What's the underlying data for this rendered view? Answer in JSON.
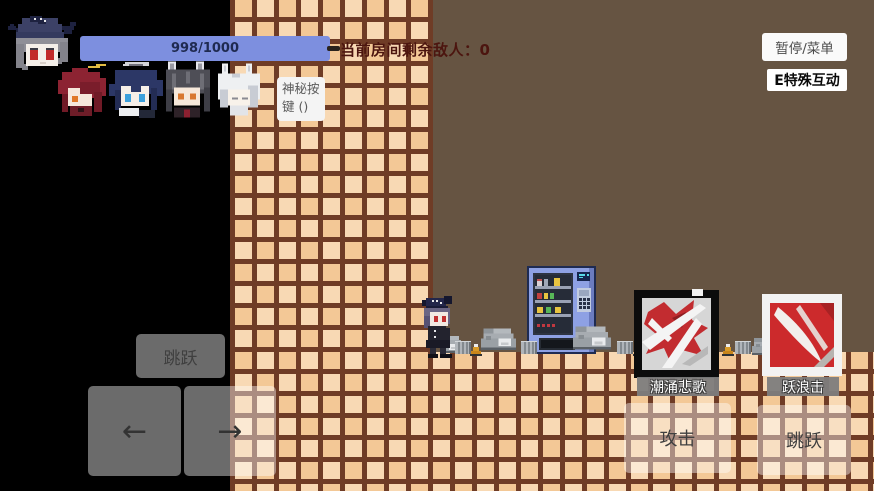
{
  "hud": {
    "health_text": "998/1000",
    "enemies_label": "当前房间剩余敌人：0",
    "pause_label": "暂停/菜单",
    "special_label": "E特殊互动",
    "mystery_label": "神秘按键 ()"
  },
  "controls": {
    "jump_top_label": "跳跃",
    "left_glyph": "←",
    "right_glyph": "→",
    "attack_label": "攻击",
    "jump_bottom_label": "跳跃"
  },
  "skills": [
    {
      "name": "潮涌悲歌"
    },
    {
      "name": "跃浪击"
    }
  ],
  "party": {
    "leader_icon": "grey-haired-operator-portrait",
    "member_icons": [
      "red-haired-operator-portrait",
      "halo-blue-operator-portrait",
      "wolf-eared-operator-portrait",
      "white-haired-operator-portrait"
    ]
  },
  "scene_icons": {
    "vending_machine": "vending-machine-sprite",
    "player": "player-character-sprite",
    "rocks": "rock-pile-sprites"
  },
  "colors": {
    "health_bar": "#7d8fdf",
    "tile": "#f6cfa2",
    "tile_grout": "#6f3c26",
    "room_background": "#665442",
    "enemies_text": "#4c150f",
    "skill1_frame": "#0c0c0c",
    "skill2_frame": "#f2f2f2",
    "control_overlay": "rgba(255,255,255,0.42)"
  }
}
